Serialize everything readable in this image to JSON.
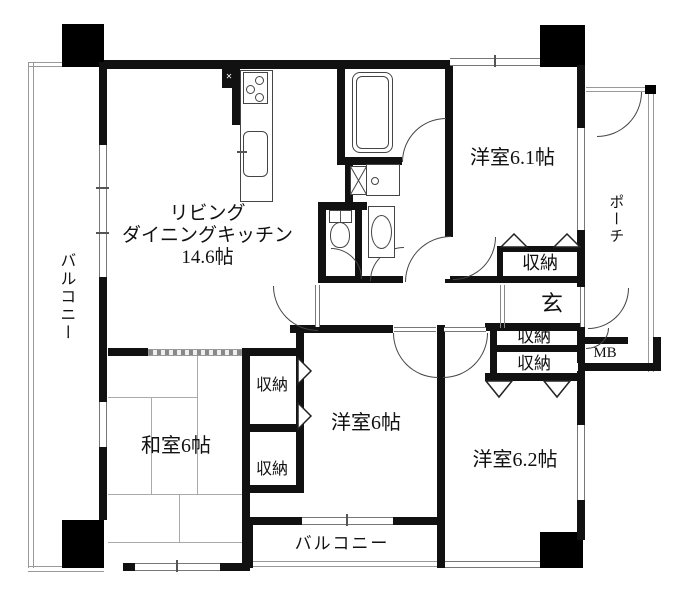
{
  "floor_plan": {
    "rooms": {
      "living_dining_kitchen": {
        "name_line1": "リビング",
        "name_line2": "ダイニングキッチン",
        "size": "14.6帖"
      },
      "western_room_6_1": {
        "label": "洋室6.1帖"
      },
      "western_room_6": {
        "label": "洋室6帖"
      },
      "western_room_6_2": {
        "label": "洋室6.2帖"
      },
      "japanese_room": {
        "label": "和室6帖"
      },
      "entrance": {
        "label": "玄"
      },
      "meter_box": {
        "label": "MB"
      },
      "porch": {
        "label": "ポーチ"
      },
      "balcony_side": {
        "label": "バルコニー"
      },
      "balcony_bottom": {
        "label": "バルコニー"
      },
      "closet_room61": {
        "label": "収納"
      },
      "closet_hall": {
        "label": "収納"
      },
      "closet_room62": {
        "label": "収納"
      },
      "closet_room6": {
        "label": "収納"
      },
      "closet_japanese": {
        "label": "収納"
      }
    },
    "colors": {
      "wall": "#111111",
      "line": "#555555",
      "background": "#ffffff"
    }
  }
}
